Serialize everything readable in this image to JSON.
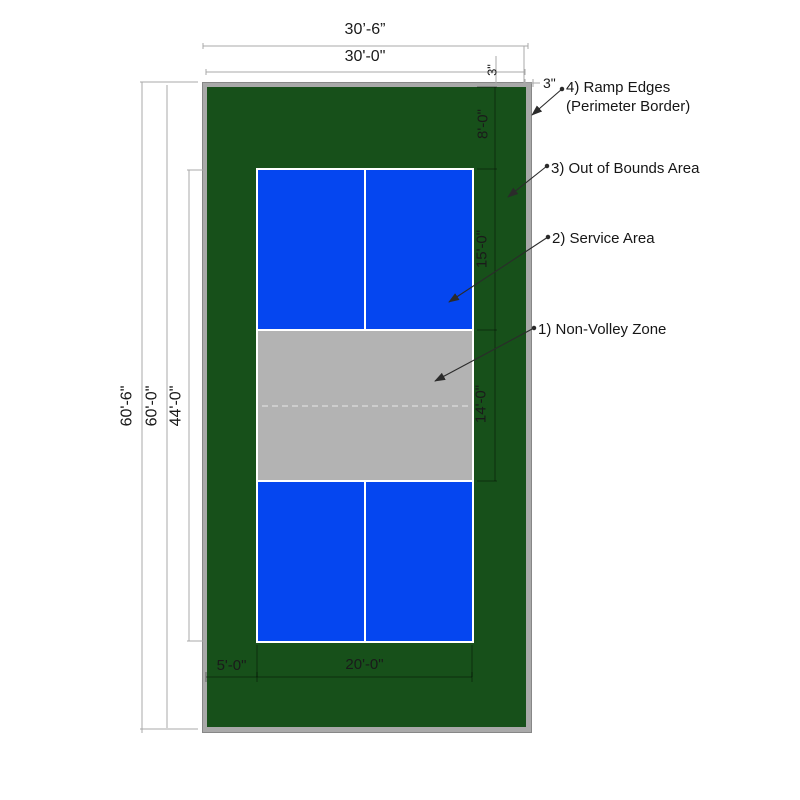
{
  "title": "Pickleball Court Dimension Diagram",
  "colors": {
    "court_green": "#17501a",
    "service_blue": "#0546f0",
    "nvz_gray": "#b3b3b3",
    "border_gray": "#a9a9a9",
    "line_white": "#ffffff"
  },
  "dimensions": {
    "overall_width": "30’-6”",
    "playing_width": "30'-0\"",
    "overall_length": "60'-6\"",
    "playing_length": "60'-0\"",
    "lined_court_length": "44'-0\"",
    "end_zone_depth": "8'-0\"",
    "service_area_depth": "15'-0\"",
    "non_volley_depth": "14'-0\"",
    "side_margin": "5'-0\"",
    "lined_court_width": "20'-0\"",
    "border_top": "3\"",
    "border_side": "3\""
  },
  "callouts": [
    {
      "label": "4) Ramp Edges",
      "label2": "(Perimeter Border)"
    },
    {
      "label": "3) Out of Bounds Area"
    },
    {
      "label": "2) Service Area"
    },
    {
      "label": "1) Non-Volley Zone"
    }
  ]
}
